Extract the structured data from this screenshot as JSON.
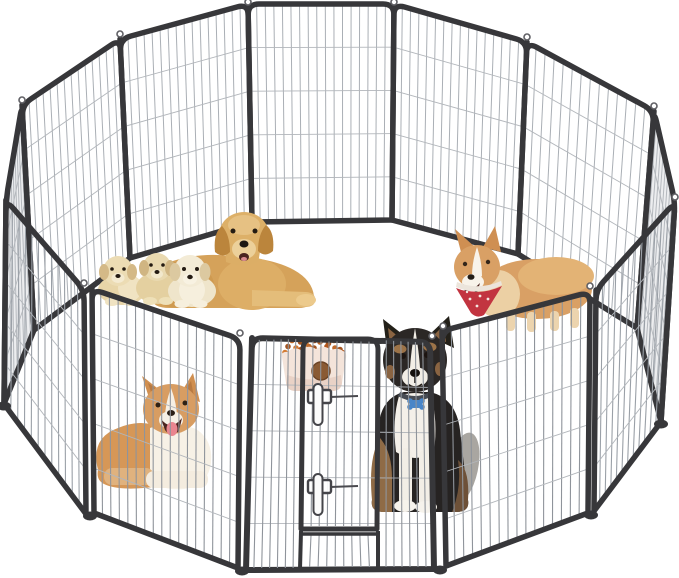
{
  "meta": {
    "description": "Product photo of a heavy-duty metal dog playpen arranged in a circle on a white background with five dogs and a food bowl inside",
    "background_color": "#ffffff"
  },
  "product": {
    "name": "heavy-duty-metal-dog-playpen",
    "panels_visible": 12,
    "frame_color": "#37373a",
    "wire_color": "#9aa0a7",
    "wire_color_far": "#aaafb5",
    "horizontal_wire_color": "#b2b6bb",
    "door": {
      "position": "front-center",
      "latch_count": 2,
      "latch_color": "#fbfbfb",
      "latch_outline": "#45454a"
    }
  },
  "animals": [
    {
      "id": "golden-retriever-mother",
      "pose": "lying",
      "location": "back-left-inside",
      "primary_color": "#d5a25a"
    },
    {
      "id": "golden-puppy-1",
      "pose": "sitting",
      "location": "left-of-mother",
      "primary_color": "#e8d5a8"
    },
    {
      "id": "golden-puppy-2",
      "pose": "sitting",
      "location": "left-of-mother",
      "primary_color": "#e4d0a0"
    },
    {
      "id": "golden-puppy-3",
      "pose": "sitting",
      "location": "front-of-mother",
      "primary_color": "#efe5cb"
    },
    {
      "id": "corgi-standing",
      "pose": "standing",
      "location": "right-inside",
      "accessory": "red-white-bandana",
      "primary_color": "#d9a065",
      "bandana_color": "#c23440"
    },
    {
      "id": "corgi-lying",
      "pose": "lying-mouth-open",
      "location": "front-left-inside",
      "primary_color": "#d69757"
    },
    {
      "id": "border-collie",
      "pose": "sitting",
      "location": "behind-front-door",
      "accessory": "blue-bone-tag",
      "primary_color": "#262322",
      "tag_color": "#4a86c8"
    }
  ],
  "props": [
    {
      "id": "food-bowl",
      "color": "#f4e4da",
      "contents": "kibble",
      "kibble_colors": [
        "#c06a2a",
        "#a35420",
        "#d47b33",
        "#b1561c"
      ],
      "decal_color": "#8a5a33"
    }
  ]
}
